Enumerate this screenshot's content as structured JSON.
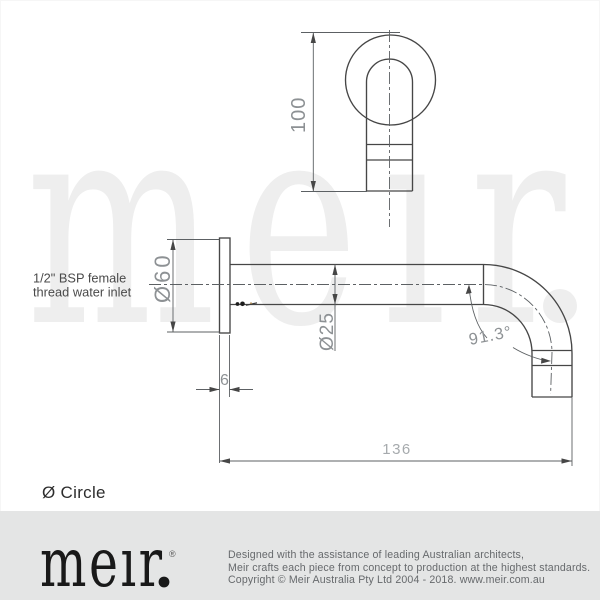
{
  "drawing": {
    "front_view": {
      "overall_height": "100"
    },
    "side_view": {
      "flange_diameter": "Ø60",
      "spout_diameter": "Ø25",
      "flange_thickness": "6",
      "spout_reach": "136",
      "bend_angle": "91.3°",
      "inlet_note_line1": "1/2\" BSP female",
      "inlet_note_line2": "thread water inlet"
    },
    "shape_note": "Ø Circle"
  },
  "watermark": {
    "wordmark": "meır"
  },
  "footer": {
    "logo": "meır",
    "registered": "®",
    "lines": [
      "Designed with the assistance of leading Australian architects,",
      "Meir crafts each piece from concept to production at the highest standards.",
      "Copyright © Meir Australia Pty Ltd 2004 - 2018. www.meir.com.au"
    ]
  },
  "colors": {
    "outline": "#464646",
    "thin_line": "#5c6063",
    "dim_text": "#8d9194",
    "dim_text_light": "#a6aaad",
    "label_text": "#4a4a4a",
    "watermark": "#eeeeee",
    "footer_bg": "#e4e5e5",
    "footer_text": "#66696c",
    "logo_black": "#191919"
  }
}
